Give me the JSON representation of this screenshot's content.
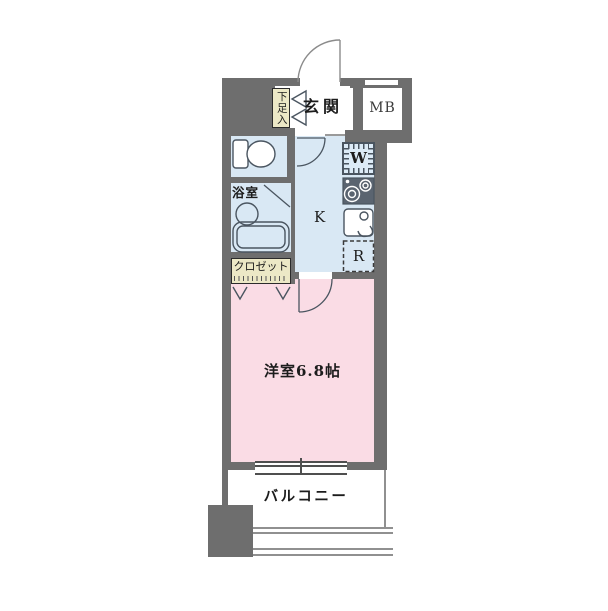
{
  "floor_plan": {
    "labels": {
      "entrance": "玄関",
      "meter_box": "MB",
      "shoe_cabinet": "下足入",
      "bathroom": "浴室",
      "closet": "クロゼット",
      "kitchen": "K",
      "washer": "W",
      "refrigerator": "R",
      "main_room": "洋室6.8帖",
      "balcony": "バルコニー"
    },
    "colors": {
      "wall": "#6e6e6e",
      "wet_area": "#d9e8f4",
      "room_pink": "#fadce5",
      "label_yellow": "#ece8c6",
      "outline": "#4a5560",
      "text": "#1c1c1c",
      "balcony_line": "#909090",
      "stove_dark": "#5a6470",
      "fixture_bg": "#dcebf7",
      "background": "#ffffff"
    }
  }
}
